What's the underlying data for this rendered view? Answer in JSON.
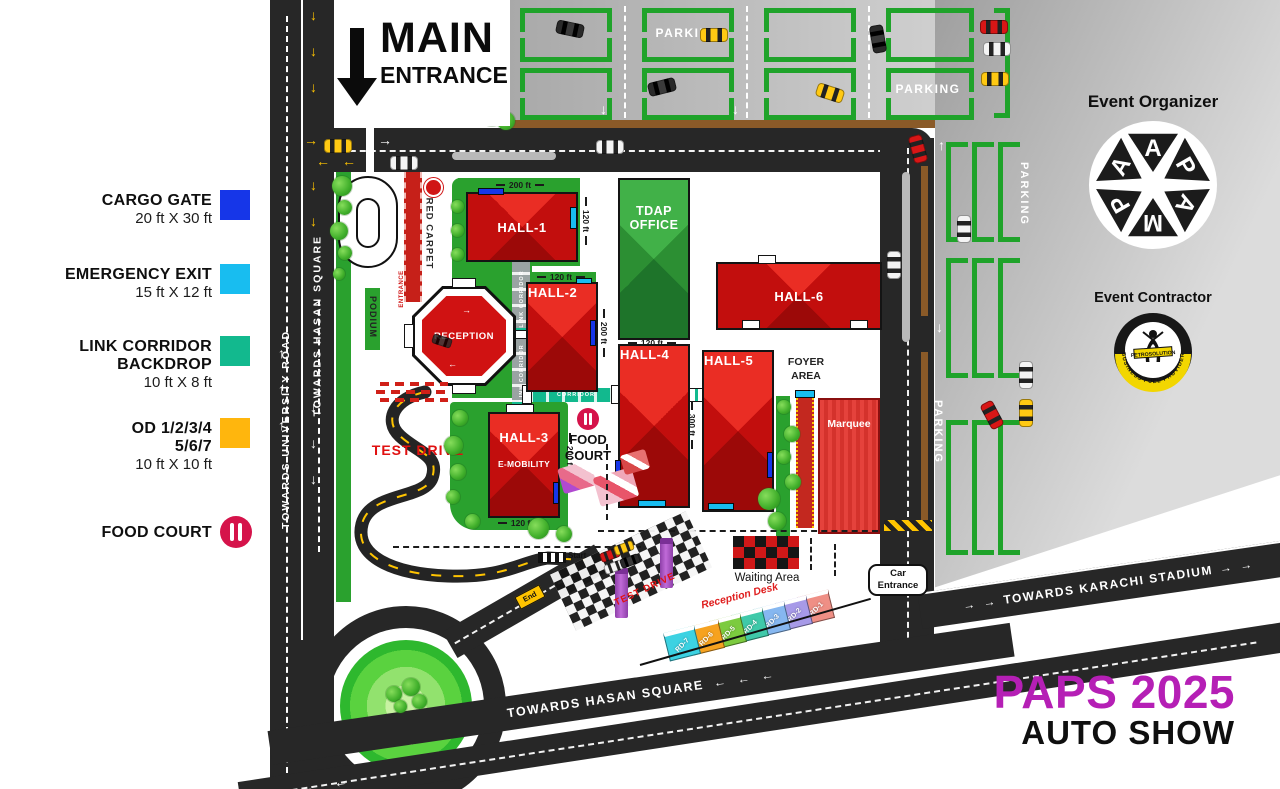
{
  "title": {
    "line1": "PAPS 2025",
    "line2": "AUTO SHOW",
    "accent": "#b51fb5"
  },
  "glyphs": {
    "up": "↑",
    "down": "↓",
    "left": "←",
    "right": "→"
  },
  "legend": {
    "items": [
      {
        "label": "CARGO GATE",
        "size": "20 ft X 30 ft",
        "color": "#1636e8"
      },
      {
        "label": "EMERGENCY EXIT",
        "size": "15 ft X 12 ft",
        "color": "#18bdf0"
      },
      {
        "label": "LINK CORRIDOR",
        "label2": "BACKDROP",
        "size": "10 ft X 8 ft",
        "color": "#12b98e"
      },
      {
        "label": "OD 1/2/3/4",
        "label2": "5/6/7",
        "size": "10 ft X 10 ft",
        "color": "#ffb60d"
      },
      {
        "label": "FOOD COURT",
        "color": "#d5134a"
      }
    ]
  },
  "entrance": {
    "line1": "MAIN",
    "line2": "ENTRANCE"
  },
  "roads": {
    "university": "TOWARDS UNIVERSITY ROAD",
    "hasan_vertical": "TOWARDS HASAN SQUARE",
    "hasan_bottom": "TOWARDS HASAN SQUARE",
    "karachi": "TOWARDS KARACHI STADIUM"
  },
  "parking_label": "PARKING",
  "buildings": {
    "hall1": "HALL-1",
    "hall2": "HALL-2",
    "hall3": "HALL-3",
    "hall3_sub": "E-MOBILITY",
    "hall4": "HALL-4",
    "hall5": "HALL-5",
    "hall6": "HALL-6",
    "tdap1": "TDAP",
    "tdap2": "OFFICE",
    "foyer1": "FOYER",
    "foyer2": "AREA",
    "marquee": "Marquee",
    "reception": "RECEPTION",
    "podium": "PODIUM",
    "red_carpet": "RED CARPET",
    "entrance_path": "ENTRANCE",
    "food1": "FOOD",
    "food2": "COURT",
    "link_corridor": "LINK CORRIDOR",
    "corridor": "CORRIDOR"
  },
  "measurements": {
    "ft120": "120 ft",
    "ft200": "200 ft",
    "ft300": "300 ft"
  },
  "areas": {
    "test_drive": "TEST DRIVE",
    "waiting": "Waiting Area",
    "car_entrance1": "Car",
    "car_entrance2": "Entrance"
  },
  "markers": {
    "start": "Start",
    "end": "End"
  },
  "reception_desks": {
    "heading": "Reception Desk",
    "items": [
      {
        "label": "RD-1",
        "color": "#ef8f85"
      },
      {
        "label": "RD-2",
        "color": "#a79ae8"
      },
      {
        "label": "RD-3",
        "color": "#86b7f0"
      },
      {
        "label": "RD-4",
        "color": "#3fc9a9"
      },
      {
        "label": "RD-5",
        "color": "#7ccb3f"
      },
      {
        "label": "RD-6",
        "color": "#f6a21f"
      },
      {
        "label": "RD-7",
        "color": "#3cd2e2"
      }
    ]
  },
  "organizer": {
    "heading": "Event Organizer",
    "letters": [
      "A",
      "P",
      "A",
      "M",
      "P",
      "A"
    ]
  },
  "contractor": {
    "heading": "Event Contractor",
    "brand": "PETROSOLUTION",
    "tagline": "BUSINESS FUEL PROVIDER"
  },
  "colors": {
    "hall_red": "#d31010",
    "building_green": "#2e9a36",
    "road_dark": "#272727",
    "marquee_red": "#e5423c",
    "pillar_purple": "#b05ad0",
    "accent_magenta": "#b51fb5"
  }
}
